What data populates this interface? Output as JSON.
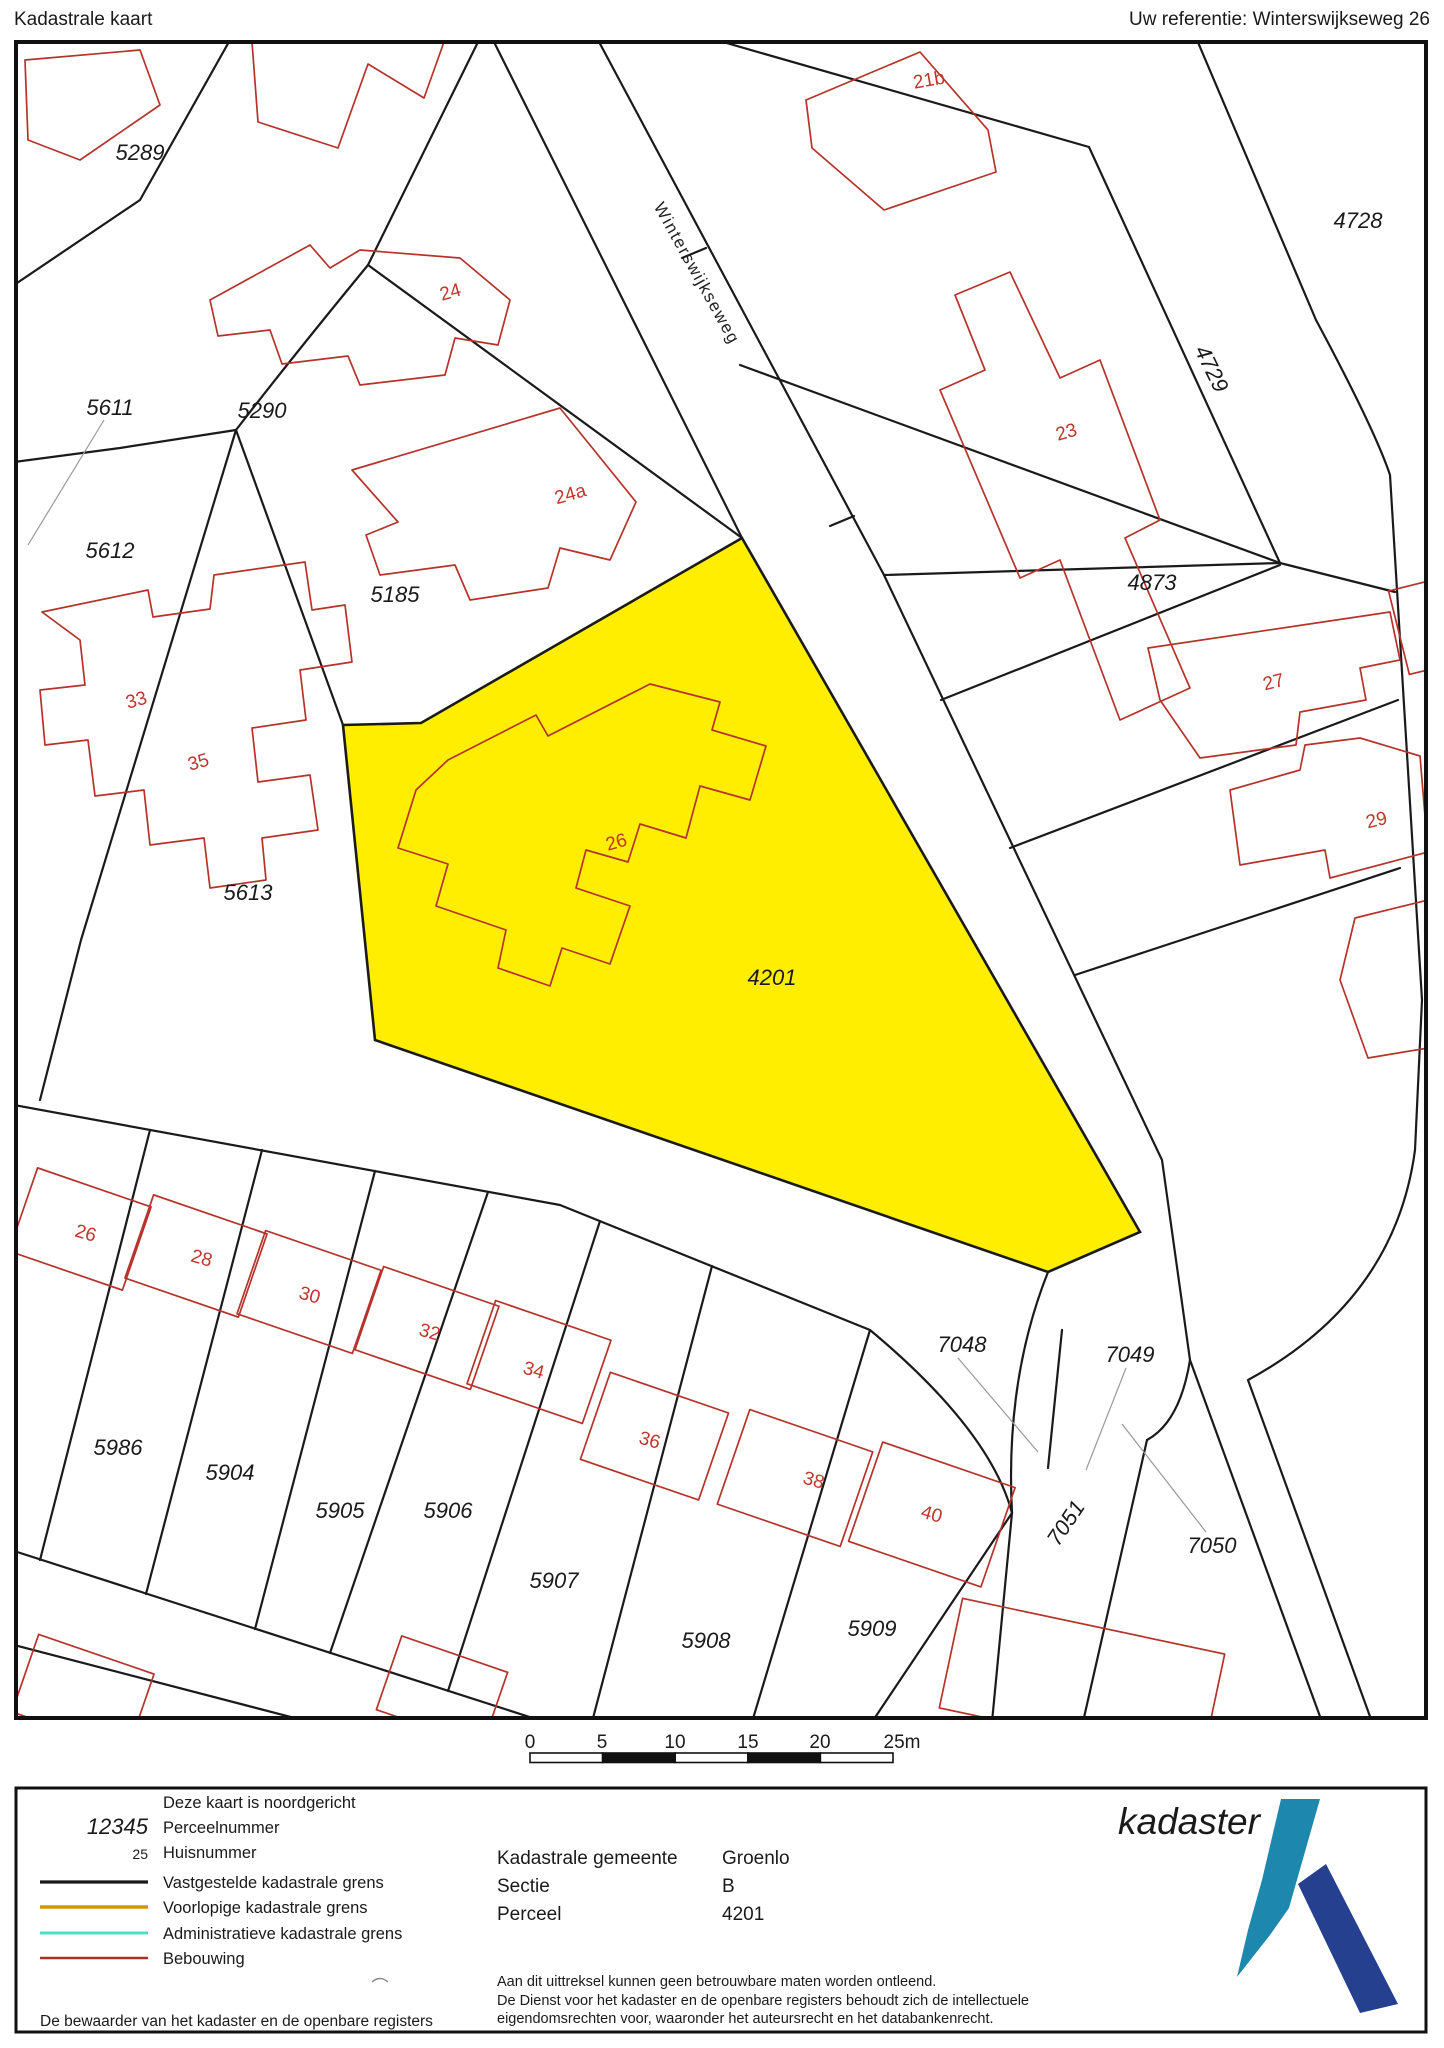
{
  "header": {
    "title": "Kadastrale kaart",
    "reference": "Uw referentie: Winterswijkseweg 26"
  },
  "map": {
    "street_name": "Winterswijkseweg",
    "parcel_labels": [
      "5289",
      "5290",
      "5611",
      "5612",
      "5185",
      "4728",
      "4729",
      "4873",
      "5613",
      "4201",
      "5986",
      "5904",
      "5905",
      "5906",
      "5907",
      "5908",
      "5909",
      "7048",
      "7049",
      "7050",
      "7051"
    ],
    "house_numbers": [
      "24",
      "24a",
      "21b",
      "23",
      "27",
      "29",
      "33",
      "35",
      "26",
      "26",
      "28",
      "30",
      "32",
      "34",
      "36",
      "38",
      "40"
    ],
    "scale_ticks": [
      "0",
      "5",
      "10",
      "15",
      "20",
      "25m"
    ]
  },
  "legend": {
    "north_note": "Deze kaart is noordgericht",
    "parcel_sample": "12345",
    "parcel_label": "Perceelnummer",
    "house_sample": "25",
    "house_label": "Huisnummer",
    "items": [
      {
        "label": "Vastgestelde kadastrale grens",
        "color": "#1a1a1a"
      },
      {
        "label": "Voorlopige kadastrale grens",
        "color": "#d4930d"
      },
      {
        "label": "Administratieve kadastrale grens",
        "color": "#4be0c3"
      },
      {
        "label": "Bebouwing",
        "color": "#a93226"
      }
    ],
    "keeper": "De bewaarder van het kadaster en de openbare registers"
  },
  "info": {
    "rows": [
      {
        "label": "Kadastrale gemeente",
        "value": "Groenlo"
      },
      {
        "label": "Sectie",
        "value": "B"
      },
      {
        "label": "Perceel",
        "value": "4201"
      }
    ],
    "disclaimer": [
      "Aan dit uittreksel kunnen geen betrouwbare maten worden ontleend.",
      "De Dienst voor het kadaster en de openbare registers behoudt zich de intellectuele",
      "eigendomsrechten voor, waaronder het auteursrecht en het databankenrecht."
    ]
  },
  "logo": {
    "text": "kadaster"
  },
  "colors": {
    "highlight": "#ffee00",
    "boundary": "#1a1a1a",
    "building": "#b5332a",
    "logo_teal": "#1e87ad",
    "logo_navy": "#25408f"
  }
}
